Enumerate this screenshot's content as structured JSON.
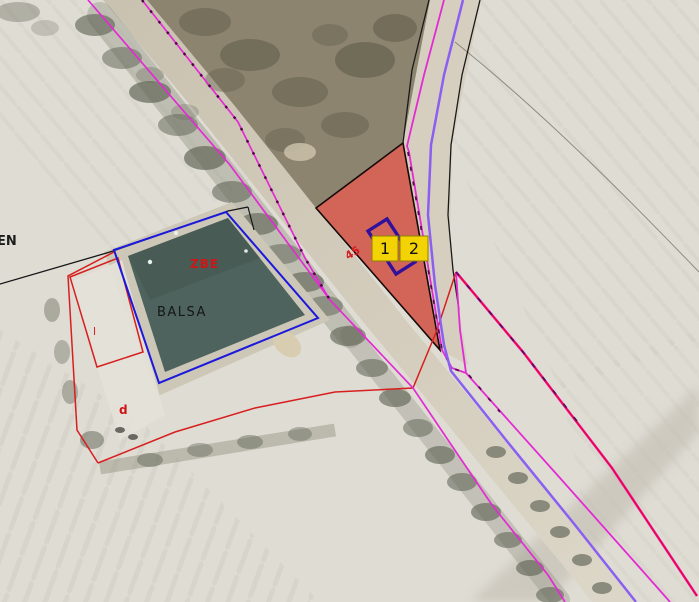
{
  "map": {
    "labels": {
      "edge_partial": "EN",
      "pond": "BALSA",
      "zone_code": "ZBE",
      "annotation_l": "l",
      "annotation_d": "d",
      "annotation_45": "45"
    },
    "markers": [
      {
        "label": "1"
      },
      {
        "label": "2"
      }
    ],
    "colors": {
      "marker_fill": "#f3d303",
      "marker_border": "#8f7f06",
      "parcel_red_fill": "#cf4a3d",
      "parcel_red_edge": "#150a08",
      "boundary_blue": "#1c18dc",
      "boundary_red": "#d71f1f",
      "line_magenta": "#e32bd3",
      "line_purple": "#8a5ff1",
      "line_red_bright": "#ee0433",
      "building_outline": "#31109b",
      "pond_fill": "#4e635e"
    }
  }
}
